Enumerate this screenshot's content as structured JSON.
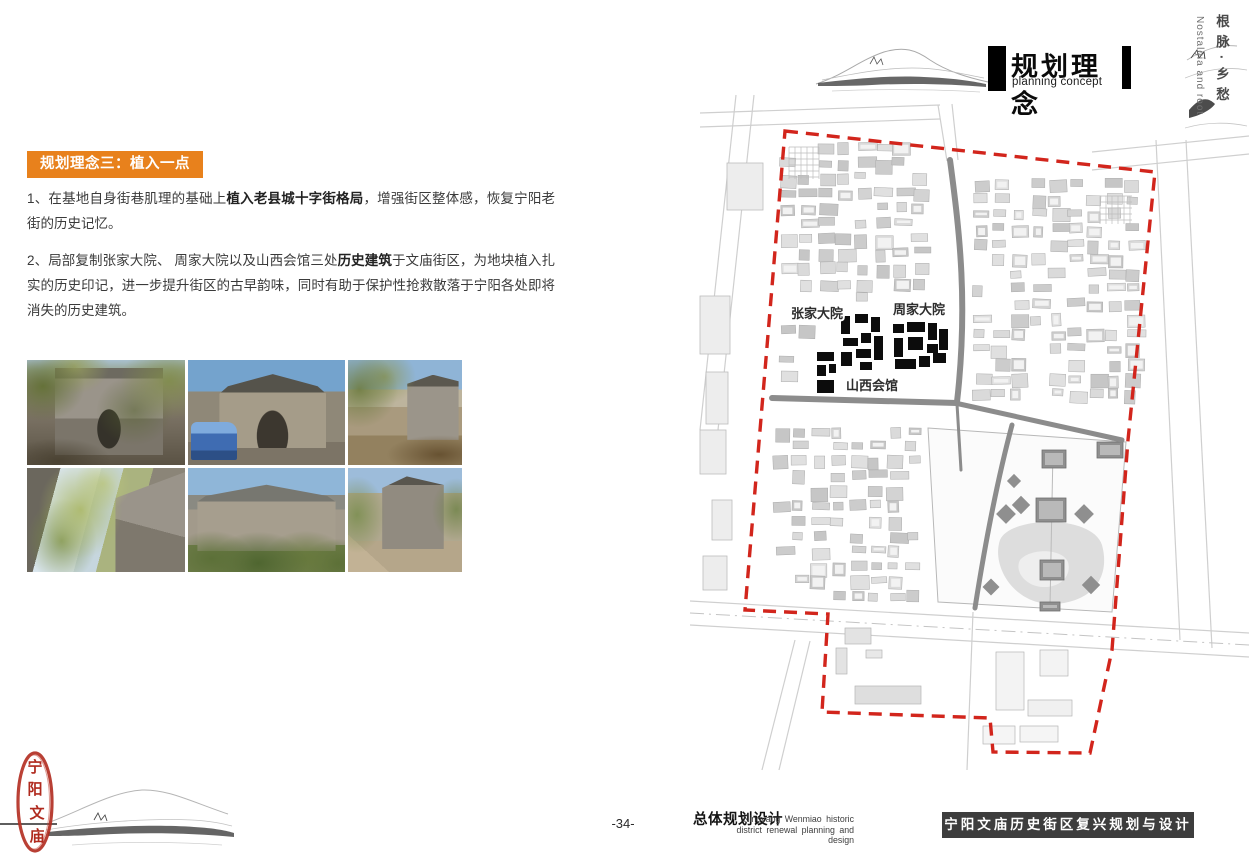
{
  "page": {
    "background": "#ffffff"
  },
  "header": {
    "title_cn": "规划理念",
    "title_en": "planning concept",
    "accent_color": "#000000"
  },
  "side_margin": {
    "vertical_cn": "根脉·乡愁",
    "vertical_en": "Nostalgia and root"
  },
  "content": {
    "section_tag": "规划理念三：植入一点",
    "tag_bg": "#E8811C",
    "paragraphs": [
      {
        "prefix": "1、在基地自身街巷肌理的基础上",
        "bold": "植入老县城十字街格局",
        "suffix": "，增强街区整体感，恢复宁阳老街的历史记忆。"
      },
      {
        "prefix": "2、局部复制张家大院、 周家大院以及山西会馆三处",
        "bold": "历史建筑",
        "suffix": "于文庙街区，为地块植入扎实的历史印记，进一步提升街区的古早韵味，同时有助于保护性抢救散落于宁阳各处即将消失的历史建筑。"
      }
    ]
  },
  "map": {
    "boundary": {
      "color": "#d2251c",
      "points": [
        [
          785,
          131
        ],
        [
          1155,
          172
        ],
        [
          1128,
          440
        ],
        [
          1112,
          650
        ],
        [
          1090,
          753
        ],
        [
          993,
          752
        ],
        [
          990,
          718
        ],
        [
          822,
          712
        ],
        [
          828,
          614
        ],
        [
          745,
          610
        ]
      ]
    },
    "road_color": "#8c8c8c",
    "roads_dark": [
      {
        "d": "M950,160 C960,235 968,305 957,402",
        "w": 6
      },
      {
        "d": "M772,398 L957,403",
        "w": 6
      },
      {
        "d": "M955,403 L1122,440",
        "w": 5
      },
      {
        "d": "M1012,425 C1000,470 988,525 975,608",
        "w": 5
      },
      {
        "d": "M957,404 L961,470",
        "w": 3
      }
    ],
    "roads_light": [
      "M700,113 L940,105",
      "M700,127 L940,119",
      "M938,105 L947,161",
      "M952,104 L958,160",
      "M1092,152 L1249,136",
      "M1092,170 L1249,154",
      "M1156,140 L1180,640",
      "M1186,140 L1212,648",
      "M736,95 L700,430",
      "M754,95 L718,430",
      "M690,601 L1249,633",
      "M690,625 L1249,657",
      "M795,640 L762,770",
      "M810,641 L779,770",
      "M973,612 L967,770"
    ],
    "road_centerlines": [
      "M690,613 L1249,645"
    ],
    "left_buildings": [
      [
        727,
        163,
        36,
        47
      ],
      [
        700,
        296,
        30,
        58
      ],
      [
        706,
        372,
        22,
        52
      ],
      [
        700,
        430,
        26,
        44
      ],
      [
        712,
        500,
        20,
        40
      ],
      [
        703,
        556,
        24,
        34
      ]
    ],
    "fabric_regions": [
      {
        "x": 778,
        "y": 142,
        "w": 166,
        "h": 254,
        "seed": 7
      },
      {
        "x": 972,
        "y": 178,
        "w": 158,
        "h": 218,
        "seed": 11
      },
      {
        "x": 772,
        "y": 410,
        "w": 152,
        "h": 190,
        "seed": 23
      }
    ],
    "fabric_skips": [
      [
        834,
        308,
        54,
        64
      ],
      [
        886,
        314,
        64,
        64
      ],
      [
        810,
        346,
        34,
        54
      ],
      [
        784,
        296,
        66,
        22
      ],
      [
        886,
        292,
        66,
        22
      ],
      [
        840,
        368,
        68,
        22
      ],
      [
        940,
        138,
        30,
        274
      ],
      [
        766,
        392,
        200,
        22
      ],
      [
        924,
        422,
        212,
        196
      ],
      [
        1004,
        416,
        40,
        14
      ]
    ],
    "grids": [
      [
        789,
        147,
        30,
        32
      ],
      [
        1100,
        196,
        32,
        28
      ]
    ],
    "clusters_color": "#0c0c0c",
    "clusters": [
      [
        841,
        316,
        9,
        18
      ],
      [
        855,
        314,
        13,
        9
      ],
      [
        871,
        317,
        9,
        15
      ],
      [
        843,
        338,
        15,
        8
      ],
      [
        861,
        333,
        10,
        10
      ],
      [
        874,
        336,
        9,
        24
      ],
      [
        841,
        352,
        11,
        14
      ],
      [
        856,
        349,
        15,
        9
      ],
      [
        860,
        362,
        12,
        8
      ],
      [
        893,
        324,
        11,
        9
      ],
      [
        907,
        322,
        18,
        10
      ],
      [
        928,
        323,
        9,
        17
      ],
      [
        894,
        338,
        9,
        19
      ],
      [
        908,
        337,
        15,
        13
      ],
      [
        927,
        344,
        11,
        9
      ],
      [
        939,
        329,
        9,
        21
      ],
      [
        895,
        359,
        21,
        10
      ],
      [
        919,
        356,
        11,
        11
      ],
      [
        933,
        353,
        13,
        10
      ],
      [
        817,
        352,
        17,
        9
      ],
      [
        817,
        365,
        9,
        11
      ],
      [
        829,
        364,
        7,
        9
      ],
      [
        817,
        380,
        17,
        13
      ]
    ],
    "temple": {
      "wall": [
        [
          928,
          428
        ],
        [
          1126,
          442
        ],
        [
          1112,
          612
        ],
        [
          938,
          602
        ]
      ],
      "pond": "M1000,540 C1010,516 1092,514 1102,545 C1110,574 1096,601 1055,604 C1014,606 991,566 1000,540 Z",
      "pond2": "M1020,560 C1030,548 1062,548 1068,562 C1072,576 1060,588 1042,587 C1026,586 1014,572 1020,560 Z",
      "pavilions": [
        {
          "x": 1042,
          "y": 450,
          "w": 24,
          "h": 18
        },
        {
          "x": 1097,
          "y": 442,
          "w": 26,
          "h": 16
        },
        {
          "x": 1036,
          "y": 498,
          "w": 30,
          "h": 24
        },
        {
          "x": 1040,
          "y": 560,
          "w": 24,
          "h": 20
        },
        {
          "x": 1040,
          "y": 602,
          "w": 20,
          "h": 9
        }
      ],
      "diamonds": [
        [
          1014,
          481,
          10
        ],
        [
          1006,
          514,
          14
        ],
        [
          1084,
          514,
          14
        ],
        [
          991,
          587,
          12
        ],
        [
          1091,
          585,
          13
        ],
        [
          1021,
          505,
          13
        ]
      ]
    },
    "south_buildings": [
      {
        "x": 845,
        "y": 628,
        "w": 26,
        "h": 16,
        "f": "#e3e3e3"
      },
      {
        "x": 836,
        "y": 648,
        "w": 11,
        "h": 26,
        "f": "#e3e3e3"
      },
      {
        "x": 866,
        "y": 650,
        "w": 16,
        "h": 8,
        "f": "#e8e8e8"
      },
      {
        "x": 855,
        "y": 686,
        "w": 66,
        "h": 18,
        "f": "#dedede"
      },
      {
        "x": 996,
        "y": 652,
        "w": 28,
        "h": 58,
        "f": "#f3f3f3"
      },
      {
        "x": 1040,
        "y": 650,
        "w": 28,
        "h": 26,
        "f": "#f3f3f3"
      },
      {
        "x": 1028,
        "y": 700,
        "w": 44,
        "h": 16,
        "f": "#f0f0f0"
      },
      {
        "x": 983,
        "y": 726,
        "w": 32,
        "h": 18,
        "f": "#f5f5f5"
      },
      {
        "x": 1020,
        "y": 726,
        "w": 38,
        "h": 16,
        "f": "#f5f5f5"
      }
    ],
    "label_color": "#2d2d2d",
    "labels": [
      {
        "text": "张家大院",
        "x": 791,
        "y": 318
      },
      {
        "text": "周家大院",
        "x": 893,
        "y": 314
      },
      {
        "text": "山西会馆",
        "x": 846,
        "y": 390
      }
    ]
  },
  "footer": {
    "page_number": "-34-",
    "series_title_cn": "总体规划设计",
    "series_title_en_line1": "Ningyang Wenmiao historic",
    "series_title_en_line2": "district renewal planning and design",
    "banner_text": "宁阳文庙历史街区复兴规划与设计",
    "banner_bg": "#3D3D3D"
  },
  "seal": {
    "color": "#b02a1e",
    "chars": [
      "宁",
      "阳",
      "文",
      "庙"
    ]
  }
}
